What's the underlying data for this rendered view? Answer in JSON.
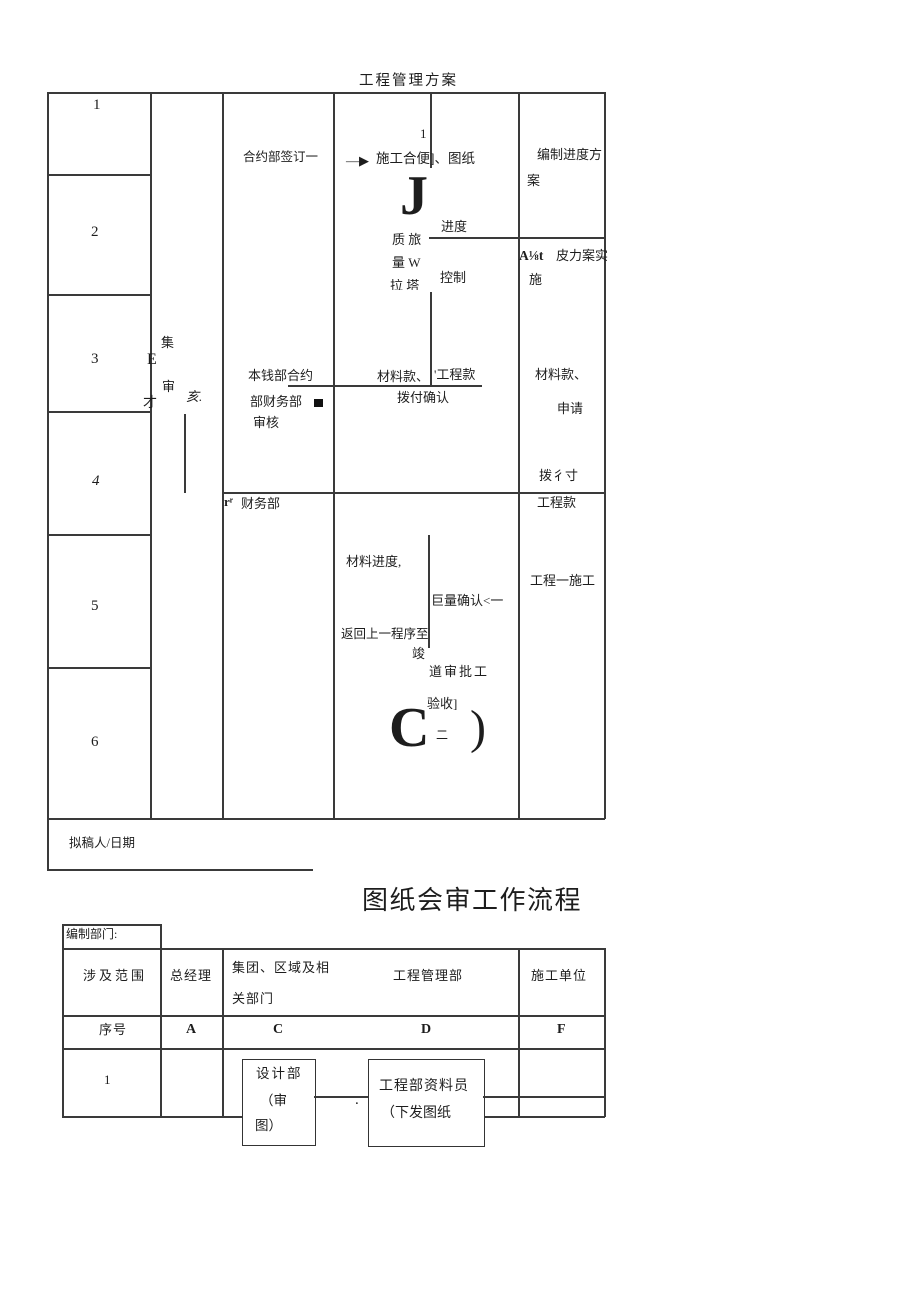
{
  "doc": {
    "title1": "工程管理方案",
    "title2": "图纸会审工作流程",
    "footer_label": "拟稿人/日期"
  },
  "t1": {
    "rownums": [
      "1",
      "2",
      "3",
      "4",
      "5",
      "6"
    ],
    "cluster": {
      "ji": "集",
      "e": "E",
      "shen": "审",
      "cai": "才",
      "hai": "亥."
    },
    "c3": {
      "sign": "合约部签订一",
      "a1": "本钱部合约",
      "a2": "部财务部",
      "a3": "审核",
      "fin_pre": "rʳ",
      "fin": "财务部"
    },
    "flow": {
      "one": "1",
      "arrow": "—▶",
      "step": "施工合便]、图纸",
      "j": "J",
      "jindu": "进度",
      "v1": "质 旅",
      "v2": "量 W",
      "v3": "拉 塔",
      "kz": "控制",
      "ck": "材料款、",
      "gk": "'工程款",
      "bf": "拨付确认",
      "mjd": "材料进度,",
      "jl": "巨量确认<一",
      "fh": "返回上一程序至",
      "jun": "竣",
      "ds": "道审批工",
      "ys": "验收]",
      "c": "C",
      "er": "二",
      "paren": ")"
    },
    "c5": {
      "r1a": "编制进度方",
      "r1b": "案",
      "r2a": "A⅛t",
      "r2b": "皮力案实",
      "r2c": "施",
      "r3a": "材料款、",
      "r3b": "申请",
      "r3c": "拨彳寸",
      "r4": "工程款",
      "r5": "工程一施工"
    }
  },
  "t2": {
    "dept": "编制部门:",
    "h1": "涉及范围",
    "h2": "总经理",
    "h3a": "集团、区域及相",
    "h3b": "关部门",
    "h4": "工程管理部",
    "h5": "施工单位",
    "l0": "序号",
    "l1": "A",
    "l2": "C",
    "l3": "D",
    "l4": "F",
    "r1": "1",
    "b1a": "设计部",
    "b1b": "（审",
    "b1c": "图）",
    "b2a": "工程部资料员",
    "b2b": "（下发图纸",
    "dot": "."
  }
}
